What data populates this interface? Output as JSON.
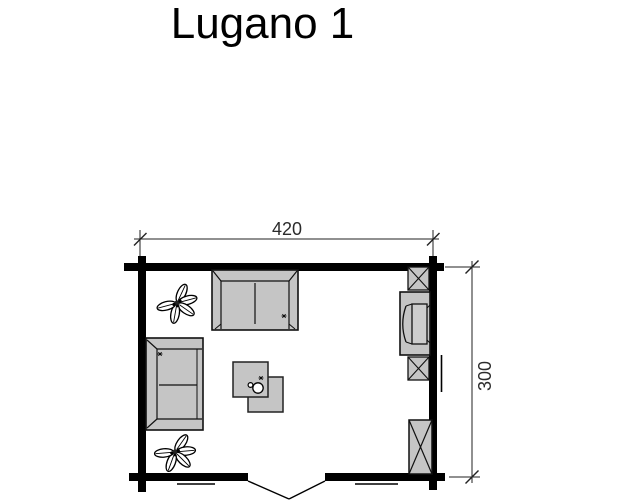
{
  "title": "Lugano 1",
  "dimensions": {
    "width_cm": "420",
    "depth_cm": "300"
  },
  "colors": {
    "background": "#ffffff",
    "wall": "#000000",
    "furniture_fill": "#c5c5c5",
    "outline": "#111111",
    "dimension_line": "#222222",
    "text": "#000000"
  },
  "floorplan": {
    "icons": [
      "sofa-top-icon",
      "sofa-left-icon",
      "coffee-tables-icon",
      "cup-icon",
      "tv-cabinet-icon",
      "crossed-box-upper-icon",
      "crossed-box-lower-icon",
      "wardrobe-icon",
      "plant-top-icon",
      "plant-bottom-icon",
      "double-door-icon",
      "window-right-icon",
      "window-bottom-left-icon",
      "window-bottom-right-icon"
    ]
  }
}
